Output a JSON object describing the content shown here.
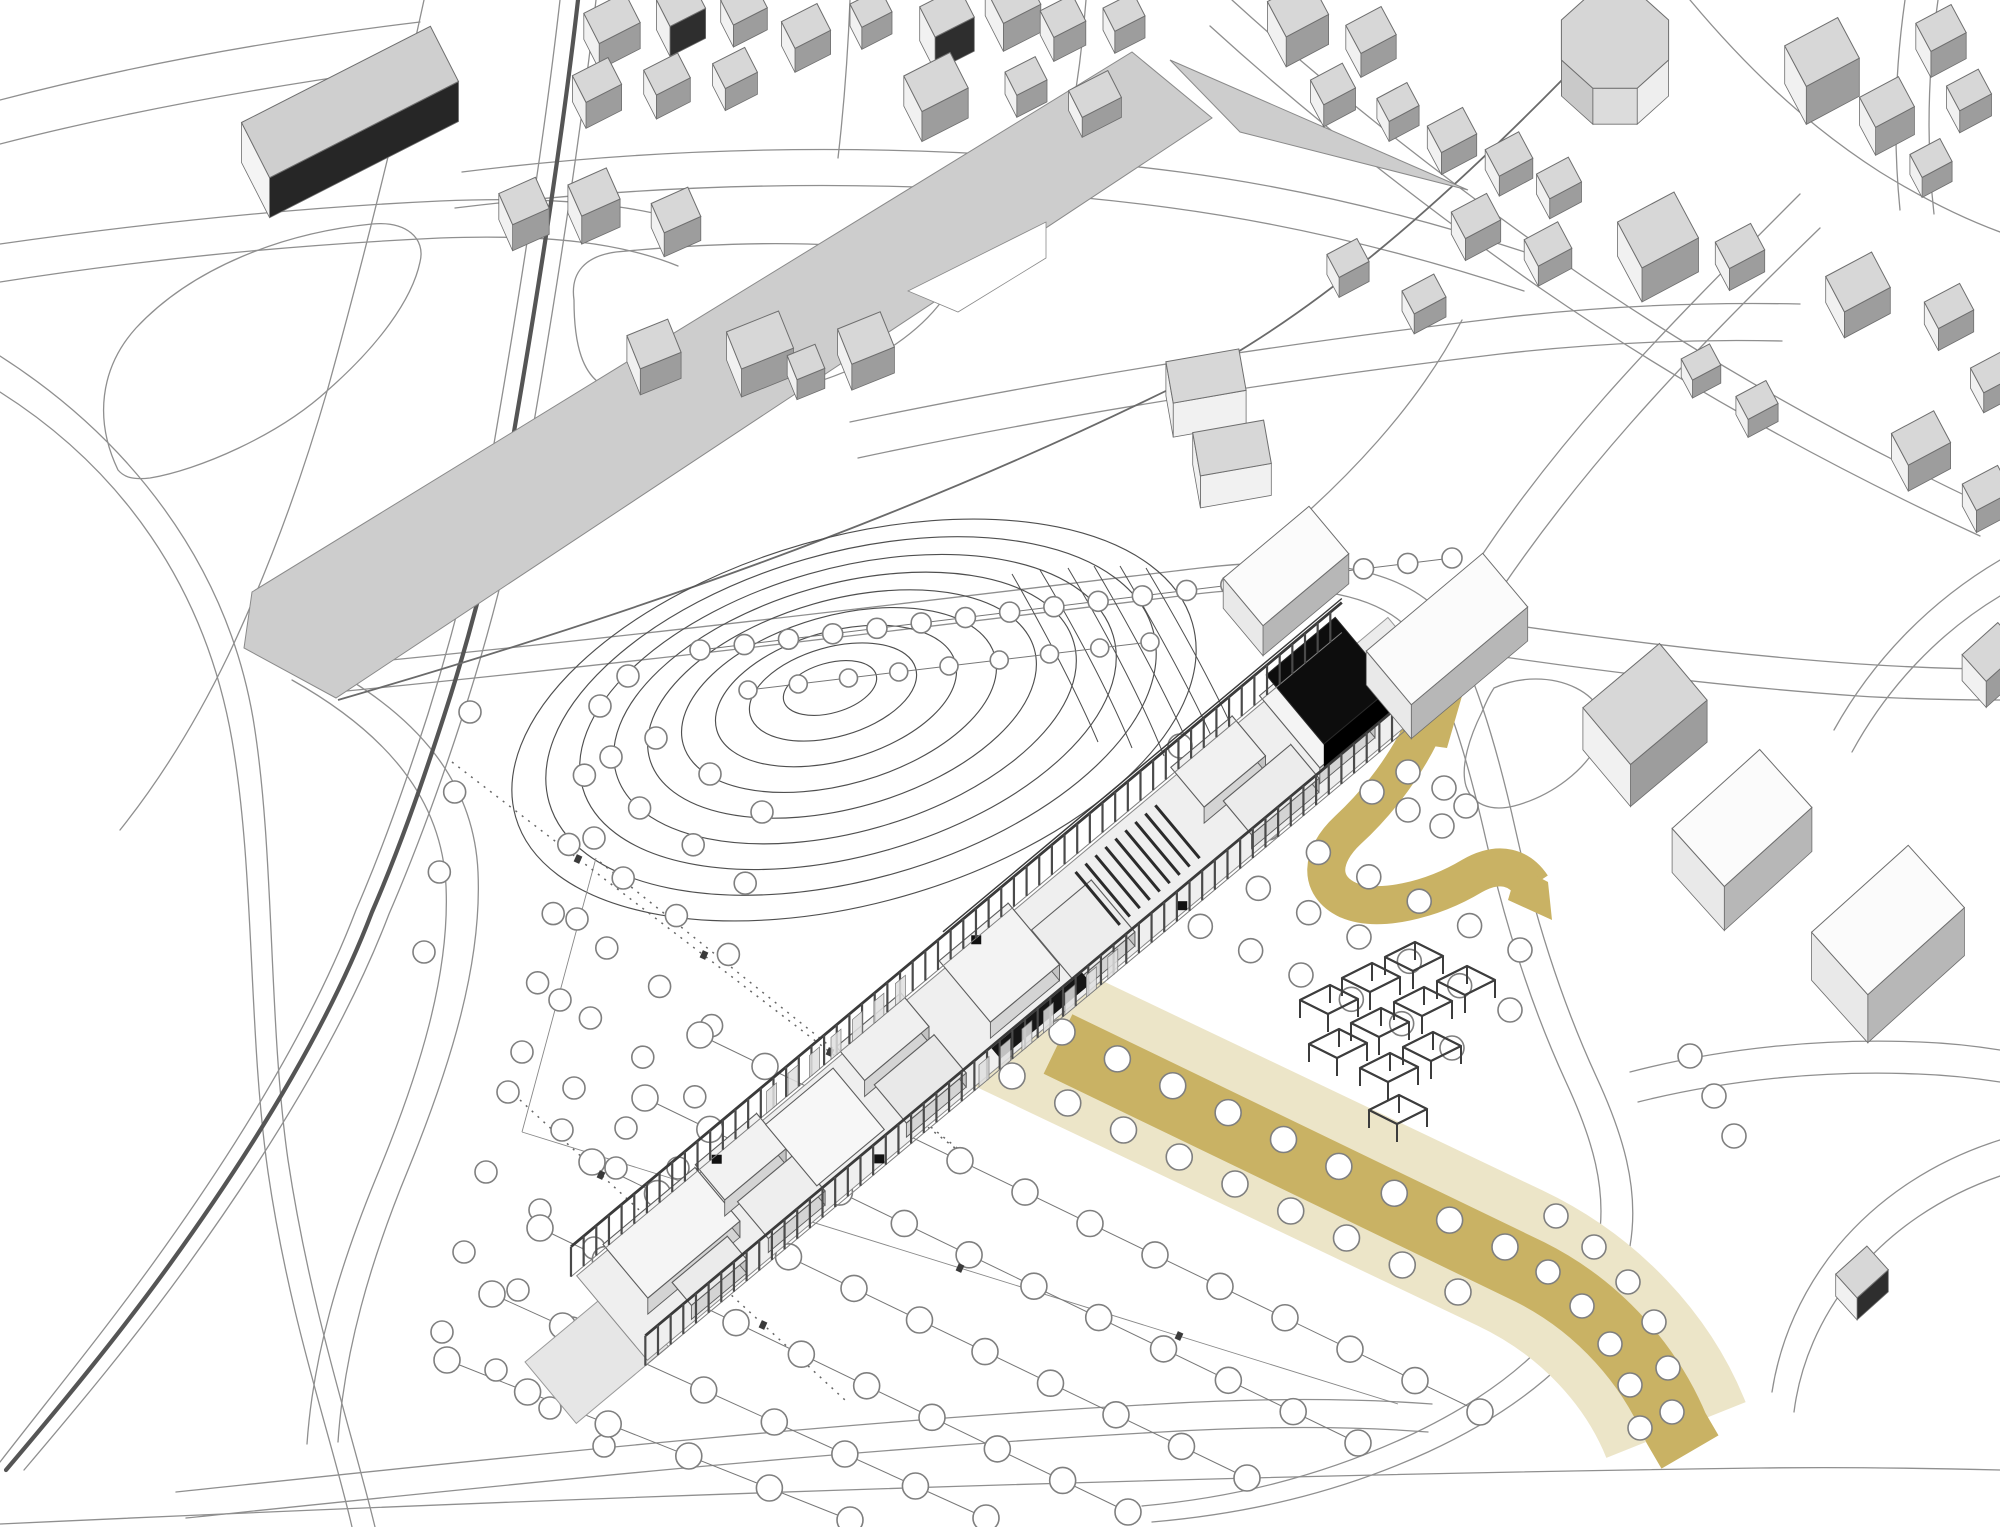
{
  "meta": {
    "description": "axonometric-architectural-site-plan-rendering",
    "visible_text": [],
    "canvas": {
      "width": 2000,
      "height": 1527
    }
  },
  "colors": {
    "background": "#ffffff",
    "road": "#8f8f8f",
    "road_dark": "#6a6a6a",
    "river": "#555555",
    "band": "#cdcdcd",
    "band_stroke": "#8a8a8a",
    "contour": "#4f4f4f",
    "ochre": "#c9b264",
    "ochre_pale": "#ece5c8",
    "tree_stroke": "#7f7f7f",
    "tree_fill": "#ffffff",
    "frame": "#3c3c3c",
    "floor": "#efefef",
    "terrace": "#e6e6e6",
    "wall_side1": "#d4d4d4",
    "wall_side2": "#c3c3c3",
    "wall_stroke": "#5d5d5d",
    "black_volume": "#0d0d0d",
    "bldg_top": "#d7d7d7",
    "bldg_side_light": "#f1f1f1",
    "bldg_side_dark": "#9d9d9d",
    "bldg_stroke": "#6e6e6e"
  },
  "roads": [
    "M 0,392 C 120,468 205,585 232,740 C 255,872 248,1032 268,1172 C 290,1322 330,1432 352,1527",
    "M 0,356 C 128,438 226,562 253,718 C 275,850 268,1020 288,1160 C 311,1312 352,1432 375,1527",
    "M 560,0 C 544,140 522,280 498,420 C 480,530 455,628 428,714 C 404,788 382,850 356,910 C 314,1020 242,1140 154,1262 C 102,1334 48,1400 0,1462",
    "M 596,0 C 580,140 558,282 534,422 C 516,532 490,632 462,718 C 438,792 415,854 389,914 C 347,1024 275,1144 187,1266 C 135,1338 80,1404 24,1470",
    "M 424,0 C 398,120 364,258 328,388 C 298,492 264,580 228,656 C 196,722 160,780 120,830",
    "M 0,100 C 130,66 270,40 420,22",
    "M 0,144 C 140,108 290,82 446,62",
    "M 0,244 C 140,224 290,208 440,201 C 560,196 640,205 700,226",
    "M 0,282 C 140,260 290,245 440,238 C 548,234 622,243 678,266",
    "M 118,470 C 94,420 100,368 136,328 C 192,268 282,233 372,224 C 406,221 426,238 420,262 C 412,300 378,346 328,390 C 278,436 198,470 150,478 C 132,480 124,477 118,470 Z",
    "M 462,172 C 700,142 950,142 1180,172 C 1302,188 1420,217 1540,257",
    "M 455,208 C 700,178 950,178 1172,208 C 1290,224 1406,252 1524,291",
    "M 838,158 C 844,106 848,52 850,0",
    "M 1062,166 C 1074,110 1082,54 1086,0",
    "M 1232,0 C 1322,82 1434,172 1562,262 C 1700,358 1850,442 2000,512",
    "M 1210,26 C 1300,108 1412,198 1540,288 C 1676,382 1828,466 1980,536",
    "M 1690,0 C 1742,62 1802,122 1880,172 C 1922,198 1962,218 2000,232",
    "M 850,422 C 1060,378 1280,344 1500,318 C 1602,306 1702,302 1800,304",
    "M 858,458 C 1064,414 1282,380 1500,354 C 1596,343 1690,339 1782,341",
    "M 1462,320 C 1420,402 1348,482 1256,556",
    "M 330,666 C 640,636 950,598 1200,568 C 1310,555 1395,566 1438,610",
    "M 336,692 C 645,662 950,624 1196,594 C 1298,582 1372,590 1410,630",
    "M 1438,610 C 1472,662 1496,742 1516,832 C 1536,922 1562,1002 1596,1076 C 1622,1132 1640,1188 1630,1246 C 1616,1332 1532,1404 1428,1452 C 1336,1494 1244,1514 1152,1522",
    "M 1410,630 C 1444,680 1466,752 1486,840 C 1506,928 1532,1008 1566,1082 C 1592,1138 1608,1190 1598,1244 C 1584,1326 1504,1392 1404,1438 C 1316,1478 1230,1498 1142,1506",
    "M 1440,614 C 1580,636 1720,654 1860,664 C 1906,667 1954,669 2000,669",
    "M 1418,644 C 1570,668 1716,686 1858,696 C 1906,699 1954,700 2000,700",
    "M 1452,602 C 1492,536 1544,466 1604,398 C 1664,330 1732,262 1800,194",
    "M 1482,618 C 1522,556 1572,490 1630,424 C 1688,358 1754,292 1820,228",
    "M 322,664 C 420,716 474,784 478,872 C 482,962 452,1062 408,1170 C 370,1262 344,1352 338,1442",
    "M 292,680 C 388,734 442,800 446,886 C 450,974 420,1072 376,1178 C 339,1268 313,1356 307,1444",
    "M 176,1492 C 500,1458 830,1422 1160,1404 C 1262,1398 1352,1398 1432,1404",
    "M 186,1518 C 505,1485 832,1450 1162,1432 C 1262,1426 1350,1426 1428,1432",
    "M 1630,1072 C 1722,1048 1822,1038 1920,1042 C 1948,1043 1975,1046 2000,1050",
    "M 1638,1102 C 1726,1080 1822,1070 1918,1074 C 1946,1075 1974,1078 2000,1082",
    "M 0,1524 C 560,1498 1160,1476 1760,1468 C 1840,1467 1920,1468 2000,1470",
    "M 2000,1176 C 1942,1196 1890,1230 1852,1278 C 1820,1318 1800,1364 1794,1412",
    "M 2000,1140 C 1936,1160 1880,1196 1838,1246 C 1802,1290 1780,1340 1772,1392",
    "M 574,300 C 570,272 586,256 616,252 C 740,240 862,240 920,258 C 948,266 954,286 938,306 C 912,338 866,368 810,384 C 730,406 650,406 608,388 C 582,377 574,344 574,300 Z",
    "M 1905,0 C 1895,70 1893,140 1900,210",
    "M 1938,0 C 1928,70 1926,142 1934,214",
    "M 2000,560 C 1932,600 1874,658 1834,730",
    "M 2000,596 C 1940,632 1888,686 1852,752",
    "M 1494,688 C 1520,676 1552,676 1576,688 C 1600,700 1608,720 1600,740 C 1586,770 1552,796 1514,806 C 1490,812 1472,804 1466,786 C 1460,766 1470,736 1482,712 C 1486,702 1490,694 1494,688 Z"
  ],
  "river": "M 578,0 C 562,140 540,280 516,420 C 498,530 472,630 444,716 C 420,790 398,852 372,912 C 330,1022 258,1142 170,1264 C 118,1336 62,1404 6,1470",
  "strip_edge": "M 338,700 C 620,618 900,522 1180,384 C 1312,318 1442,202 1562,80",
  "band": {
    "main": [
      [
        252,
        592
      ],
      [
        1132,
        52
      ],
      [
        1212,
        118
      ],
      [
        336,
        698
      ],
      [
        244,
        648
      ]
    ],
    "wedge": [
      [
        1170,
        60
      ],
      [
        1468,
        190
      ],
      [
        1240,
        132
      ]
    ],
    "notch": [
      [
        908,
        291
      ],
      [
        1046,
        222
      ],
      [
        1046,
        258
      ],
      [
        958,
        312
      ]
    ]
  },
  "contours": {
    "cx": 830,
    "cy": 688,
    "count": 9,
    "rx0": 48,
    "rxstep": 38,
    "ryf": 0.52,
    "rot": -16,
    "dx": 3,
    "dy": 4
  },
  "fan": [
    "M 1012,574 C 1050,640 1080,700 1098,742",
    "M 1040,570 C 1082,640 1114,704 1132,748",
    "M 1068,568 C 1112,642 1146,710 1164,756",
    "M 1094,566 C 1140,644 1176,714 1196,762",
    "M 1120,566 C 1168,648 1206,720 1226,770",
    "M 1146,568 C 1196,652 1234,726 1254,778"
  ],
  "thin_lines": [
    "M 522,1132 L 1398,1404",
    "M 596,858 L 522,1132"
  ],
  "dotted": [
    "M 452,762 L 955,1148",
    "M 600,862 L 962,1152",
    "M 520,1100 L 845,1400",
    "M 988,1002 L 1588,1290"
  ],
  "ochre": {
    "pale": "M 985,1008 C 1160,1092 1335,1176 1510,1258 C 1590,1296 1648,1360 1676,1430",
    "dark": "M 1058,1044 C 1230,1126 1400,1208 1530,1272 C 1600,1307 1650,1366 1676,1428 L 1690,1452",
    "loop": "M 1420,735 C 1400,775 1372,808 1348,830 C 1320,856 1318,886 1348,900 C 1378,913 1432,900 1472,876 C 1500,860 1520,868 1532,886",
    "flares": [
      [
        [
          1384,
          692
        ],
        [
          1462,
          696
        ],
        [
          1447,
          748
        ],
        [
          1404,
          742
        ]
      ],
      [
        [
          1518,
          866
        ],
        [
          1548,
          882
        ],
        [
          1552,
          920
        ],
        [
          1508,
          900
        ]
      ]
    ],
    "pale_w": 150,
    "dark_w": 66,
    "loop_w": 38
  },
  "tree_rows": [
    [
      700,
      650,
      1452,
      558,
      18,
      10,
      1
    ],
    [
      748,
      690,
      1150,
      642,
      9,
      9,
      1
    ],
    [
      628,
      676,
      560,
      1000,
      5,
      11,
      0
    ],
    [
      600,
      706,
      522,
      1052,
      6,
      11,
      0
    ],
    [
      656,
      738,
      574,
      1088,
      6,
      11,
      0
    ],
    [
      710,
      774,
      626,
      1128,
      6,
      11,
      0
    ],
    [
      762,
      812,
      678,
      1168,
      6,
      11,
      0
    ],
    [
      470,
      712,
      424,
      952,
      4,
      11,
      0
    ],
    [
      508,
      1092,
      442,
      1332,
      4,
      11,
      0
    ],
    [
      562,
      1130,
      496,
      1370,
      4,
      11,
      0
    ],
    [
      616,
      1168,
      550,
      1408,
      4,
      11,
      0
    ],
    [
      670,
      1206,
      604,
      1446,
      4,
      11,
      0
    ],
    [
      700,
      1035,
      1480,
      1412,
      13,
      13,
      1
    ],
    [
      645,
      1098,
      1358,
      1443,
      12,
      13,
      1
    ],
    [
      592,
      1162,
      1247,
      1478,
      11,
      13,
      1
    ],
    [
      540,
      1228,
      1128,
      1512,
      10,
      13,
      1
    ],
    [
      492,
      1294,
      986,
      1518,
      8,
      13,
      1
    ],
    [
      447,
      1360,
      850,
      1520,
      6,
      13,
      1
    ],
    [
      1062,
      1032,
      1505,
      1247,
      9,
      13,
      0
    ],
    [
      1012,
      1076,
      1458,
      1292,
      9,
      13,
      0
    ],
    [
      1150,
      902,
      1452,
      1048,
      7,
      12,
      0
    ],
    [
      1208,
      864,
      1510,
      1010,
      7,
      12,
      0
    ],
    [
      1268,
      828,
      1520,
      950,
      6,
      12,
      0
    ]
  ],
  "tree_extra": [
    [
      1548,
      1272
    ],
    [
      1582,
      1306
    ],
    [
      1610,
      1344
    ],
    [
      1630,
      1385
    ],
    [
      1640,
      1428
    ],
    [
      1556,
      1216
    ],
    [
      1594,
      1247
    ],
    [
      1628,
      1282
    ],
    [
      1654,
      1322
    ],
    [
      1668,
      1368
    ],
    [
      1672,
      1412
    ],
    [
      1408,
      772
    ],
    [
      1444,
      788
    ],
    [
      1372,
      792
    ],
    [
      1408,
      810
    ],
    [
      1442,
      826
    ],
    [
      1466,
      806
    ],
    [
      1180,
      746
    ],
    [
      1216,
      764
    ],
    [
      1252,
      782
    ],
    [
      1288,
      800
    ],
    [
      1690,
      1056
    ],
    [
      1714,
      1096
    ],
    [
      1734,
      1136
    ]
  ],
  "ticks": [
    [
      578,
      859
    ],
    [
      704,
      955
    ],
    [
      830,
      1052
    ],
    [
      601,
      1175
    ],
    [
      682,
      1250
    ],
    [
      763,
      1325
    ],
    [
      741,
      1200
    ],
    [
      960,
      1268
    ],
    [
      1179,
      1336
    ]
  ],
  "pergolas": [
    [
      1300,
      1000
    ],
    [
      1342,
      978
    ],
    [
      1385,
      957
    ],
    [
      1309,
      1044
    ],
    [
      1351,
      1023
    ],
    [
      1394,
      1002
    ],
    [
      1437,
      981
    ],
    [
      1360,
      1068
    ],
    [
      1403,
      1047
    ],
    [
      1369,
      1110
    ]
  ],
  "building": {
    "origin": [
      612,
      1318
    ],
    "u": [
      0.767,
      -0.641
    ],
    "v": [
      0.641,
      0.767
    ],
    "length": 1000,
    "half_width": 55,
    "rail_v": 58,
    "beam_h": 30,
    "post_step": 16.5,
    "terrace": [
      -95,
      25,
      -22,
      58
    ],
    "ne_terrace": [
      988,
      1045,
      -40,
      30
    ],
    "rooms": [
      [
        30,
        150,
        -50,
        20,
        16,
        "#f5f5f5"
      ],
      [
        60,
        132,
        22,
        52,
        14,
        "#ebebeb"
      ],
      [
        152,
        232,
        -52,
        -6,
        16,
        "#f2f2f2"
      ],
      [
        162,
        236,
        2,
        50,
        14,
        "#eeeeee"
      ],
      [
        242,
        330,
        -50,
        30,
        0,
        "#f7f7f7"
      ],
      [
        336,
        420,
        -52,
        -8,
        16,
        "#f0f0f0"
      ],
      [
        342,
        420,
        0,
        50,
        14,
        "#e9e9e9"
      ],
      [
        470,
        560,
        -52,
        28,
        16,
        "#f3f3f3"
      ],
      [
        562,
        640,
        -18,
        50,
        14,
        "#ededed"
      ],
      [
        772,
        852,
        -52,
        0,
        16,
        "#f1f1f1"
      ],
      [
        792,
        880,
        6,
        50,
        14,
        "#ececec"
      ],
      [
        886,
        958,
        -50,
        44,
        16,
        "#f4f4f4"
      ]
    ],
    "auditorium": {
      "u0": 642,
      "rows": 9,
      "step": 13,
      "v1": -45,
      "v2": 24
    },
    "black_band": [
      458,
      576,
      44,
      58
    ],
    "black_volume": [
      898,
      988,
      -54,
      36,
      26
    ],
    "doors": [
      [
        180,
        -52
      ],
      [
        520,
        -54
      ],
      [
        305,
        52
      ],
      [
        700,
        52
      ]
    ],
    "glass_nw": [
      250,
      420
    ],
    "glass_se": [
      430,
      600
    ]
  },
  "city_buildings": [
    [
      350,
      142,
      212,
      62,
      -27,
      40,
      "g"
    ],
    [
      612,
      44,
      46,
      34,
      -27,
      26,
      ""
    ],
    [
      681,
      34,
      40,
      30,
      -27,
      30,
      "k"
    ],
    [
      744,
      26,
      38,
      28,
      -27,
      22,
      ""
    ],
    [
      806,
      50,
      40,
      30,
      -27,
      24,
      ""
    ],
    [
      871,
      30,
      34,
      26,
      -27,
      22,
      ""
    ],
    [
      947,
      46,
      44,
      34,
      -27,
      34,
      "k"
    ],
    [
      1013,
      24,
      42,
      40,
      -27,
      28,
      ""
    ],
    [
      1063,
      40,
      36,
      30,
      -27,
      24,
      ""
    ],
    [
      1124,
      34,
      34,
      26,
      -27,
      22,
      ""
    ],
    [
      597,
      106,
      40,
      30,
      -27,
      26,
      ""
    ],
    [
      667,
      98,
      38,
      28,
      -27,
      24,
      ""
    ],
    [
      735,
      90,
      36,
      28,
      -27,
      22,
      ""
    ],
    [
      936,
      112,
      52,
      40,
      -27,
      30,
      ""
    ],
    [
      1026,
      98,
      34,
      26,
      -27,
      22,
      ""
    ],
    [
      1095,
      114,
      44,
      30,
      -27,
      20,
      ""
    ],
    [
      524,
      227,
      40,
      34,
      -24,
      26,
      ""
    ],
    [
      594,
      220,
      42,
      34,
      -24,
      28,
      ""
    ],
    [
      676,
      234,
      40,
      32,
      -24,
      24,
      ""
    ],
    [
      654,
      370,
      44,
      36,
      -22,
      26,
      ""
    ],
    [
      760,
      368,
      56,
      40,
      -22,
      28,
      ""
    ],
    [
      806,
      382,
      30,
      26,
      -22,
      20,
      ""
    ],
    [
      866,
      364,
      46,
      38,
      -22,
      26,
      ""
    ],
    [
      1206,
      410,
      74,
      42,
      -10,
      34,
      ""
    ],
    [
      1232,
      480,
      72,
      44,
      -10,
      32,
      ""
    ],
    [
      1298,
      38,
      48,
      40,
      -28,
      30,
      ""
    ],
    [
      1371,
      54,
      40,
      32,
      -28,
      24,
      ""
    ],
    [
      1333,
      106,
      36,
      28,
      -28,
      22,
      ""
    ],
    [
      1398,
      122,
      34,
      26,
      -28,
      20,
      ""
    ],
    [
      1452,
      152,
      40,
      30,
      -28,
      22,
      ""
    ],
    [
      1509,
      174,
      38,
      30,
      -28,
      20,
      ""
    ],
    [
      1559,
      198,
      36,
      28,
      -28,
      20,
      ""
    ],
    [
      1476,
      238,
      40,
      30,
      -28,
      22,
      ""
    ],
    [
      1548,
      264,
      38,
      30,
      -28,
      20,
      ""
    ],
    [
      1424,
      314,
      36,
      26,
      -28,
      20,
      ""
    ],
    [
      1348,
      278,
      34,
      26,
      -28,
      20,
      ""
    ],
    [
      1822,
      90,
      60,
      46,
      -28,
      38,
      ""
    ],
    [
      1887,
      130,
      44,
      34,
      -28,
      28,
      ""
    ],
    [
      1941,
      54,
      40,
      32,
      -28,
      26,
      ""
    ],
    [
      1969,
      112,
      36,
      28,
      -28,
      22,
      ""
    ],
    [
      1931,
      178,
      34,
      26,
      -28,
      20,
      ""
    ],
    [
      1658,
      264,
      64,
      52,
      -28,
      34,
      ""
    ],
    [
      1740,
      268,
      40,
      30,
      -28,
      22,
      ""
    ],
    [
      1858,
      308,
      52,
      40,
      -28,
      26,
      ""
    ],
    [
      1949,
      328,
      40,
      30,
      -28,
      22,
      ""
    ],
    [
      1993,
      392,
      36,
      28,
      -28,
      20,
      ""
    ],
    [
      1757,
      418,
      34,
      26,
      -28,
      18,
      ""
    ],
    [
      1701,
      380,
      32,
      24,
      -28,
      18,
      ""
    ],
    [
      1921,
      464,
      48,
      36,
      -28,
      26,
      ""
    ],
    [
      1987,
      510,
      40,
      30,
      -28,
      22,
      ""
    ],
    [
      1286,
      596,
      112,
      62,
      -40,
      30,
      "w"
    ],
    [
      1447,
      663,
      152,
      70,
      -40,
      34,
      "w"
    ],
    [
      1645,
      746,
      100,
      74,
      -40,
      42,
      ""
    ],
    [
      1742,
      862,
      118,
      78,
      -42,
      44,
      "w"
    ],
    [
      1888,
      968,
      130,
      84,
      -42,
      48,
      "w"
    ],
    [
      1862,
      1294,
      42,
      32,
      -42,
      22,
      "k"
    ],
    [
      1992,
      678,
      48,
      36,
      -42,
      26,
      ""
    ]
  ],
  "octagon": {
    "cx": 1615,
    "cy": 76,
    "r": 58,
    "ryf": 0.9,
    "h": 36
  }
}
